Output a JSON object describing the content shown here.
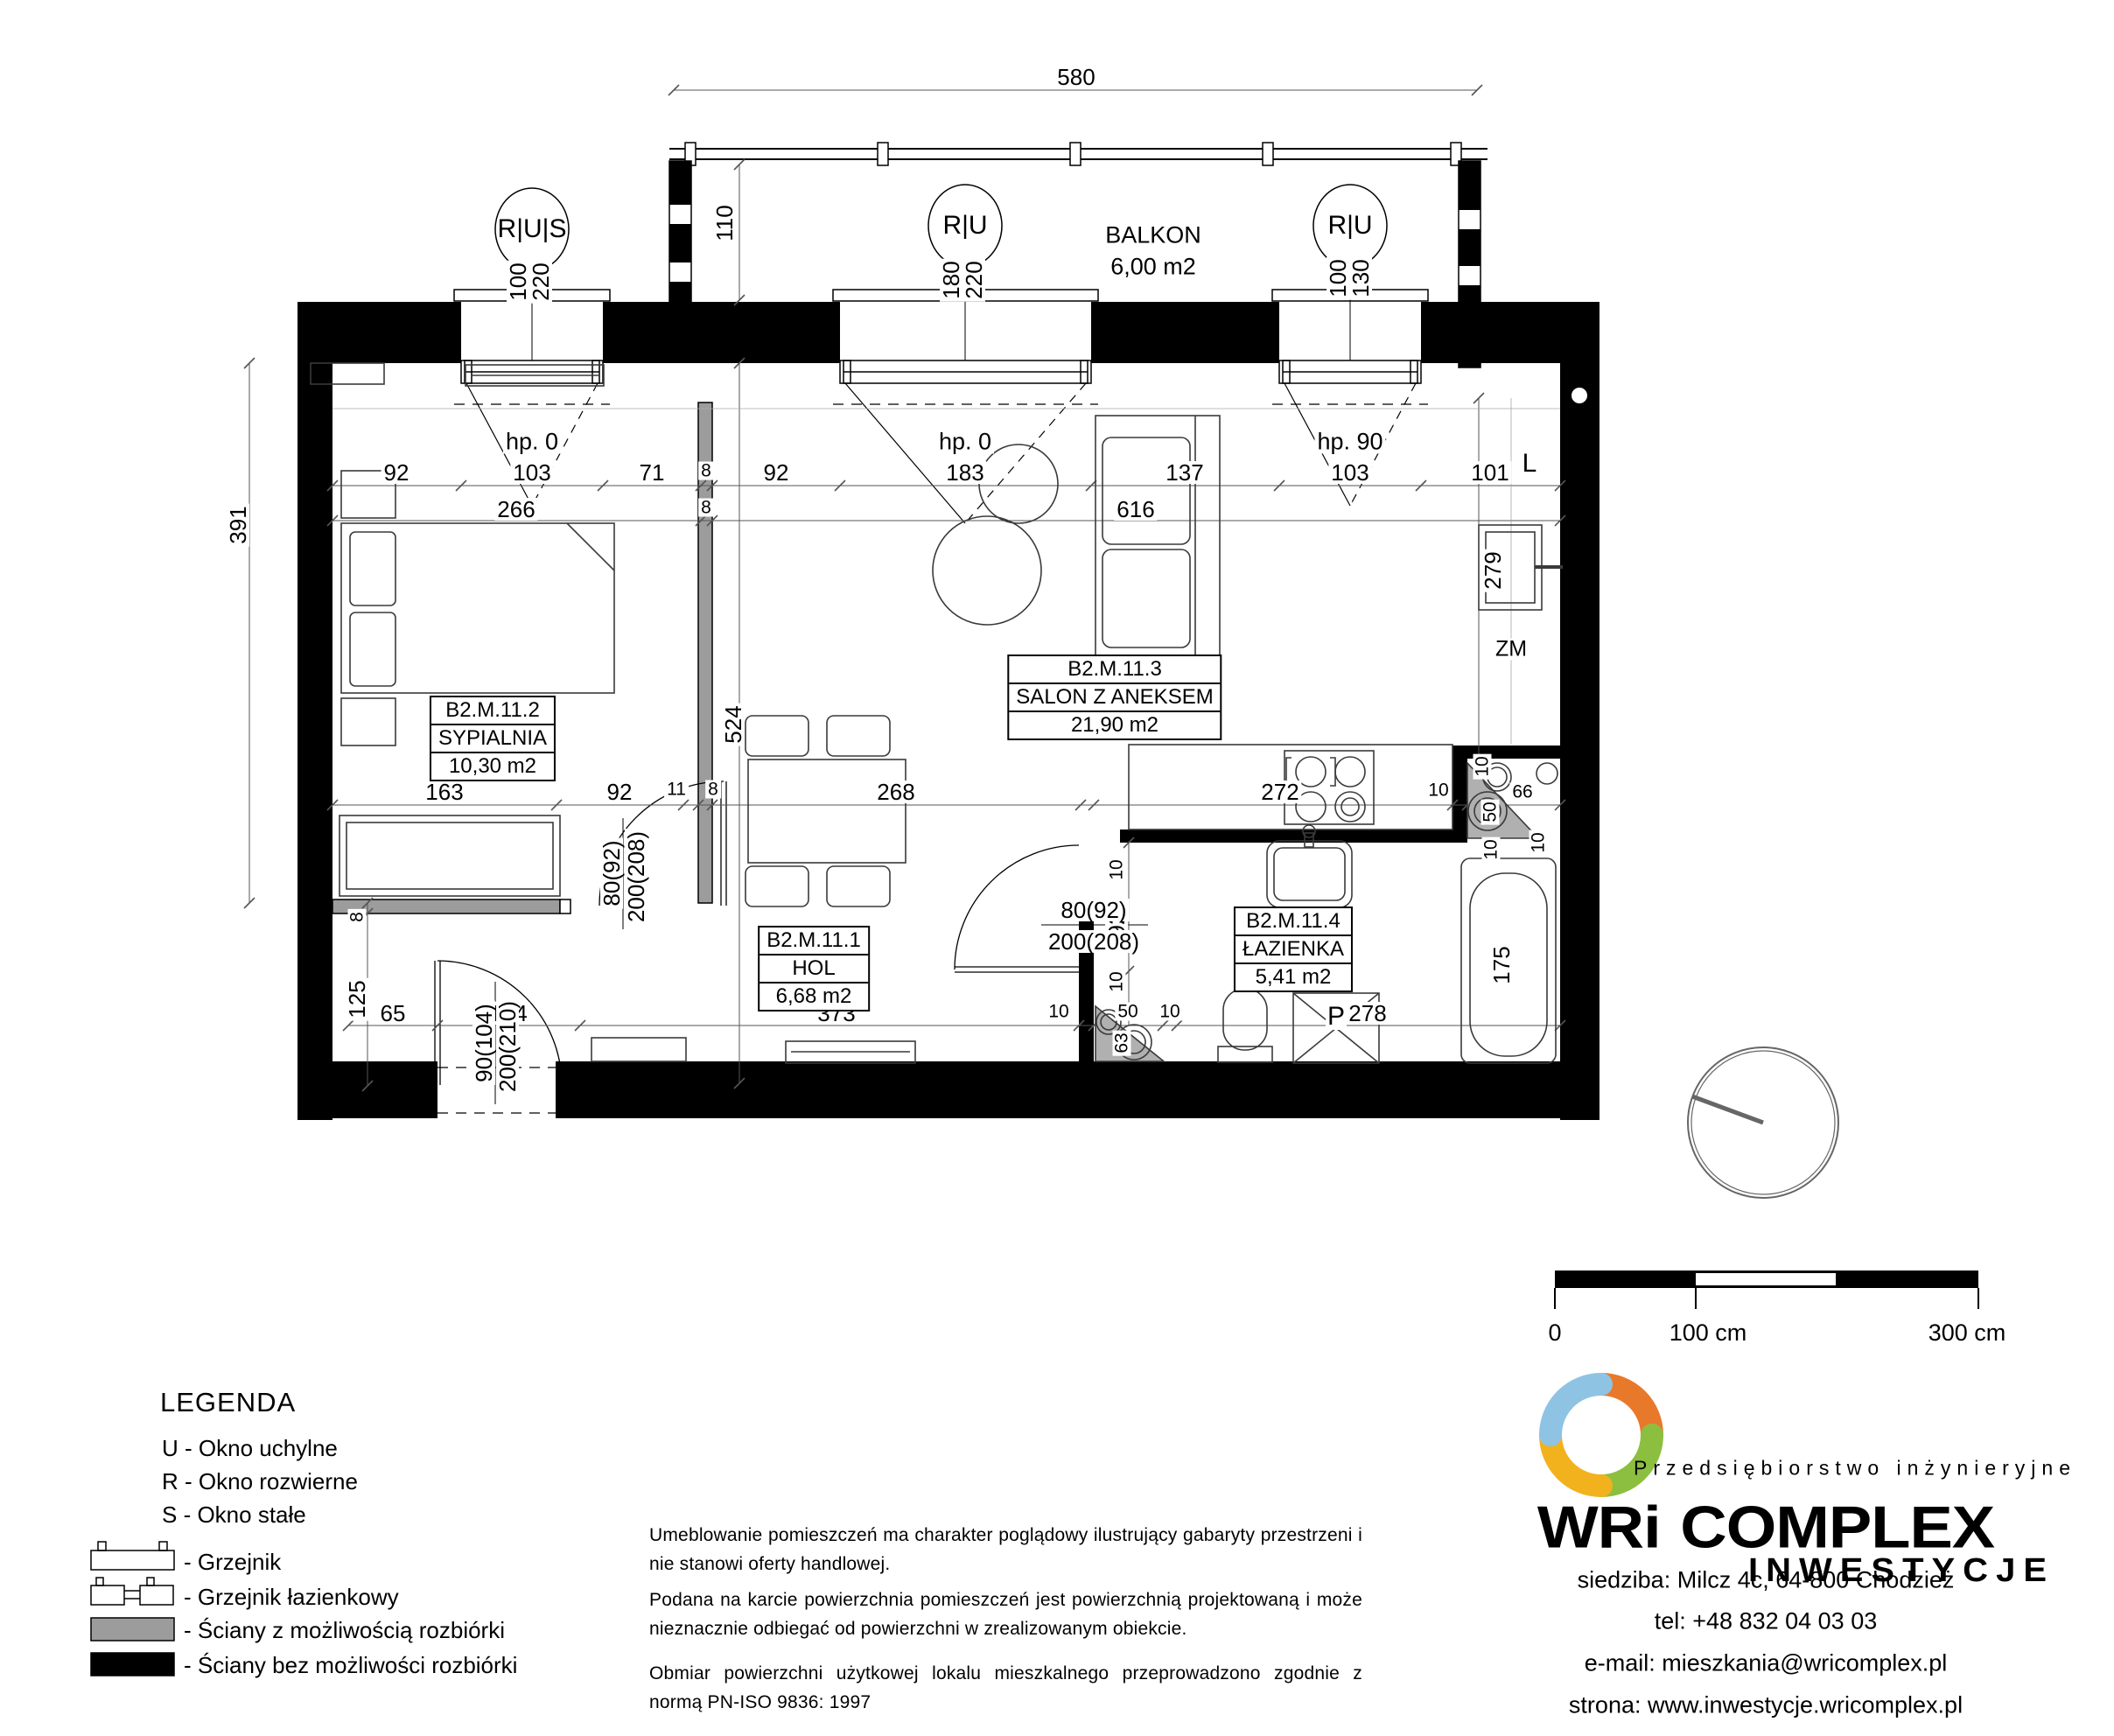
{
  "balcony": {
    "name": "BALKON",
    "area": "6,00 m2"
  },
  "windows": {
    "w1": {
      "tag": "R|U|S",
      "a": "100",
      "b": "220",
      "hp": "hp. 0"
    },
    "w2": {
      "tag": "R|U",
      "a": "180",
      "b": "220",
      "hp": "hp. 0"
    },
    "w3": {
      "tag": "R|U",
      "a": "100",
      "b": "130",
      "hp": "hp. 90"
    }
  },
  "rooms": {
    "hol": {
      "id": "B2.M.11.1",
      "name": "HOL",
      "area": "6,68 m2"
    },
    "sypialnia": {
      "id": "B2.M.11.2",
      "name": "SYPIALNIA",
      "area": "10,30 m2"
    },
    "salon": {
      "id": "B2.M.11.3",
      "name": "SALON Z ANEKSEM",
      "area": "21,90 m2"
    },
    "lazienka": {
      "id": "B2.M.11.4",
      "name": "ŁAZIENKA",
      "area": "5,41 m2"
    }
  },
  "doors": {
    "bedroom": {
      "w": "80(92)",
      "h": "200(208)"
    },
    "bathroom": {
      "w": "80(92)",
      "h": "200(208)"
    },
    "entry": {
      "w": "90(104)",
      "h": "200(210)"
    }
  },
  "appliances": {
    "dishwasher": "ZM",
    "fridge": "L",
    "washer": "P"
  },
  "dims": {
    "top": "580",
    "depth": "110",
    "r1a": "92",
    "r1b": "103",
    "r1c": "71",
    "r1d": "8",
    "r1e": "92",
    "r1f": "183",
    "r1g": "137",
    "r1h": "103",
    "r1i": "101",
    "r2a": "266",
    "r2b": "8",
    "r2c": "616",
    "m1": "163",
    "m2": "92",
    "m3": "11",
    "m4": "8",
    "m5": "268",
    "m6": "272",
    "m7": "10",
    "m8": "66",
    "c1": "10",
    "c2": "50",
    "l1": "391",
    "l2": "8",
    "l3": "125",
    "b1": "65",
    "b2": "104",
    "b3": "373",
    "b4": "10",
    "b5": "50",
    "b6": "10",
    "b7": "278",
    "v63": "63",
    "v92": "92",
    "v10a": "10",
    "v10b": "10",
    "v10c": "10",
    "v10d": "10",
    "tub": "175",
    "wall524": "524",
    "right279": "279"
  },
  "legend": {
    "title": "LEGENDA",
    "i1": "U - Okno uchylne",
    "i2": "R - Okno rozwierne",
    "i3": "S - Okno stałe",
    "i4": "- Grzejnik",
    "i5": "- Grzejnik łazienkowy",
    "i6": "- Ściany z możliwością rozbiórki",
    "i7": "- Ściany bez możliwości rozbiórki"
  },
  "notes": {
    "n1": "Umeblowanie pomieszczeń ma charakter poglądowy ilustrujący gabaryty przestrzeni i nie stanowi oferty handlowej.",
    "n2": "Podana na karcie powierzchnia pomieszczeń jest powierzchnią projektowaną i może nieznacznie odbiegać od powierzchni w zrealizowanym obiekcie.",
    "n3": "Obmiar powierzchni użytkowej lokalu mieszkalnego przeprowadzono zgodnie z normą PN-ISO 9836: 1997"
  },
  "scalebar": {
    "t0": "0",
    "t1": "100 cm",
    "t2": "300 cm"
  },
  "brand": {
    "tagline": "Przedsiębiorstwo inżynieryjne",
    "name1": "WRi",
    "name2": "COMPLEX",
    "name3": "INWESTYCJE",
    "addr": "siedziba: Milcz 4c, 64-800 Chodzież",
    "tel": "tel: +48 832 04 03 03",
    "email": "e-mail: mieszkania@wricomplex.pl",
    "web": "strona: www.inwestycje.wricomplex.pl"
  }
}
